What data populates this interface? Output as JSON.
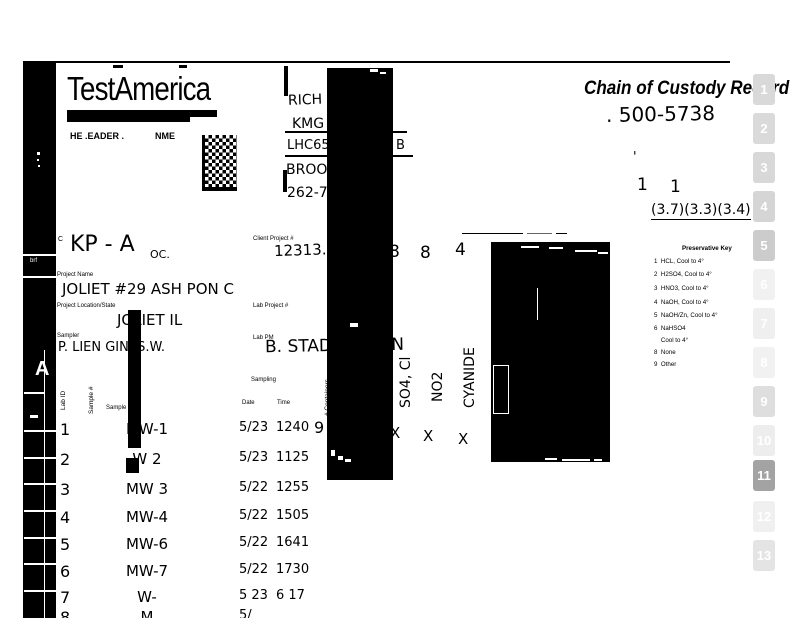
{
  "logo": {
    "name": "TestAmerica",
    "tagline_a": "HE .EADER .",
    "tagline_b": "NME"
  },
  "header": {
    "title": "Chain of Custody Record",
    "coc_number": ". 500-5738",
    "tick": "'",
    "count_left": "1",
    "count_right": "1",
    "temperatures": "(3.7)(3.3)(3.4)"
  },
  "client_block": {
    "line1": "RICH B",
    "line2": "KMG",
    "line3": "LHC65 W",
    "line3_suffix": "B",
    "line4": "BROOK",
    "line5": "262-7"
  },
  "form": {
    "client_prefix": "C",
    "client_value": "KP - A",
    "client_value2": "OC.",
    "client_project_label": "Client Project #",
    "client_project_value": "12313.D",
    "project_name_label": "Project Name",
    "project_name_value": "JOLIET #29 ASH PON C",
    "project_location_label": "Project Location/State",
    "project_location_value": "JOLIET IL",
    "lab_project_label": "Lab Project #",
    "sampler_label": "Sampler",
    "sampler_value": "P. LIEN GIN .S.W.",
    "lab_pm_label": "Lab PM",
    "lab_pm_value": "B. STADELMANN"
  },
  "table": {
    "headers": {
      "lab_id": "Lab ID",
      "sample_no": "Sample #",
      "sample_desc": "Sample D",
      "sampling": "Sampling",
      "date": "Date",
      "time": "Time",
      "containers": "# Containers"
    },
    "rows": [
      {
        "no": "1",
        "desc": "MW-1",
        "date": "5/23",
        "time": "1240"
      },
      {
        "no": "2",
        "desc": "W 2",
        "date": "5/23",
        "time": "1125"
      },
      {
        "no": "3",
        "desc": "MW 3",
        "date": "5/22",
        "time": "1255"
      },
      {
        "no": "4",
        "desc": "MW-4",
        "date": "5/22",
        "time": "1505"
      },
      {
        "no": "5",
        "desc": "MW-6",
        "date": "5/22",
        "time": "1641"
      },
      {
        "no": "6",
        "desc": "MW-7",
        "date": "5/22",
        "time": "1730"
      },
      {
        "no": "7",
        "desc": "W-",
        "date": "5 23",
        "time": "6 17"
      },
      {
        "no": "8",
        "desc": "M",
        "date": "5/",
        "time": ""
      }
    ]
  },
  "analyses": {
    "count_hidden": "8",
    "count_no2": "8",
    "count_cyanide": "4",
    "row1_containers": "9",
    "col1": "SO4, Cl",
    "col2": "NO2",
    "col3": "CYANIDE",
    "mark1": "X",
    "mark2": "X",
    "mark3": "X"
  },
  "preservative_key": {
    "title": "Preservative Key",
    "items": [
      "1  HCL, Cool to 4°",
      "2  H2SO4, Cool to 4°",
      "3  HNO3, Cool to 4°",
      "4  NaOH, Cool to 4°",
      "5  NaOH/Zn, Cool to 4°",
      "6  NaHSO4",
      "    Cool to 4°",
      "8  None",
      "9  Other"
    ]
  },
  "left_band": {
    "stamp": "brf",
    "mark": "A"
  },
  "side_tabs": [
    "1",
    "2",
    "3",
    "4",
    "5",
    "6",
    "7",
    "8",
    "9",
    "10",
    "11",
    "12",
    "13"
  ]
}
